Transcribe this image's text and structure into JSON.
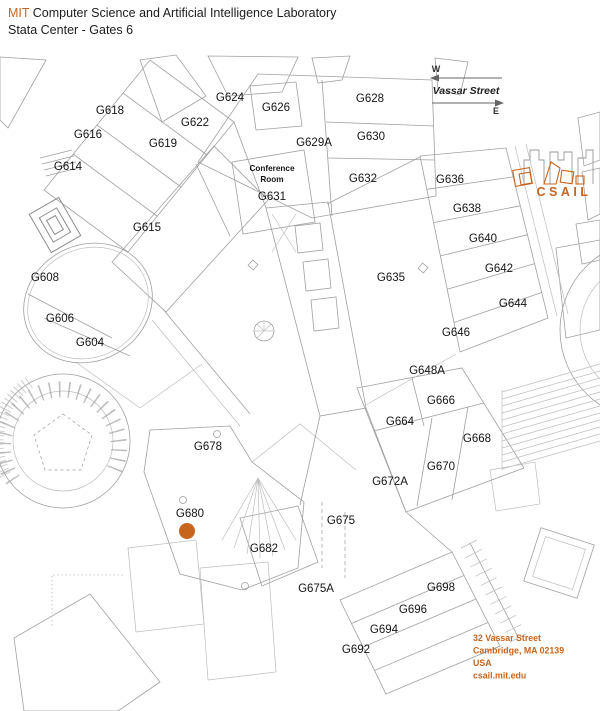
{
  "header": {
    "brand": "MIT",
    "title": "Computer Science and Artificial Intelligence Laboratory",
    "subtitle": "Stata Center - Gates 6"
  },
  "compass": {
    "west": "W",
    "east": "E",
    "street": "Vassar Street"
  },
  "logo": {
    "text": "CSAIL"
  },
  "address": {
    "lines": [
      "32 Vassar Street",
      "Cambridge, MA 02139",
      "USA",
      "csail.mit.edu"
    ]
  },
  "colors": {
    "accent": "#C8651D",
    "map_line": "#A0A0A0",
    "label": "#141414"
  },
  "marker": {
    "room": "G680",
    "x": 187,
    "y": 531,
    "radius": 8
  },
  "rooms": [
    {
      "label": "G618",
      "x": 110,
      "y": 110
    },
    {
      "label": "G616",
      "x": 88,
      "y": 134
    },
    {
      "label": "G614",
      "x": 68,
      "y": 166
    },
    {
      "label": "G619",
      "x": 163,
      "y": 143
    },
    {
      "label": "G622",
      "x": 195,
      "y": 122
    },
    {
      "label": "G624",
      "x": 230,
      "y": 97
    },
    {
      "label": "G626",
      "x": 276,
      "y": 107
    },
    {
      "label": "G628",
      "x": 370,
      "y": 98
    },
    {
      "label": "G629A",
      "x": 314,
      "y": 142
    },
    {
      "label": "G630",
      "x": 371,
      "y": 136
    },
    {
      "label": "G632",
      "x": 363,
      "y": 178
    },
    {
      "label": "Conference",
      "x": 272,
      "y": 168,
      "small": true
    },
    {
      "label": "Room",
      "x": 272,
      "y": 179,
      "small": true
    },
    {
      "label": "G631",
      "x": 272,
      "y": 196
    },
    {
      "label": "G615",
      "x": 147,
      "y": 227
    },
    {
      "label": "G636",
      "x": 450,
      "y": 179
    },
    {
      "label": "G638",
      "x": 467,
      "y": 208
    },
    {
      "label": "G640",
      "x": 483,
      "y": 238
    },
    {
      "label": "G642",
      "x": 499,
      "y": 268
    },
    {
      "label": "G644",
      "x": 513,
      "y": 303
    },
    {
      "label": "G646",
      "x": 456,
      "y": 332
    },
    {
      "label": "G635",
      "x": 391,
      "y": 277
    },
    {
      "label": "G648A",
      "x": 427,
      "y": 370
    },
    {
      "label": "G666",
      "x": 441,
      "y": 400
    },
    {
      "label": "G664",
      "x": 400,
      "y": 421
    },
    {
      "label": "G668",
      "x": 477,
      "y": 438
    },
    {
      "label": "G670",
      "x": 441,
      "y": 466
    },
    {
      "label": "G672A",
      "x": 390,
      "y": 481
    },
    {
      "label": "G678",
      "x": 208,
      "y": 446
    },
    {
      "label": "G680",
      "x": 190,
      "y": 513
    },
    {
      "label": "G682",
      "x": 264,
      "y": 548
    },
    {
      "label": "G675",
      "x": 341,
      "y": 520
    },
    {
      "label": "G675A",
      "x": 316,
      "y": 588
    },
    {
      "label": "G698",
      "x": 441,
      "y": 587
    },
    {
      "label": "G696",
      "x": 413,
      "y": 609
    },
    {
      "label": "G694",
      "x": 384,
      "y": 629
    },
    {
      "label": "G692",
      "x": 356,
      "y": 649
    },
    {
      "label": "G608",
      "x": 45,
      "y": 277
    },
    {
      "label": "G606",
      "x": 60,
      "y": 318
    },
    {
      "label": "G604",
      "x": 90,
      "y": 342
    }
  ]
}
